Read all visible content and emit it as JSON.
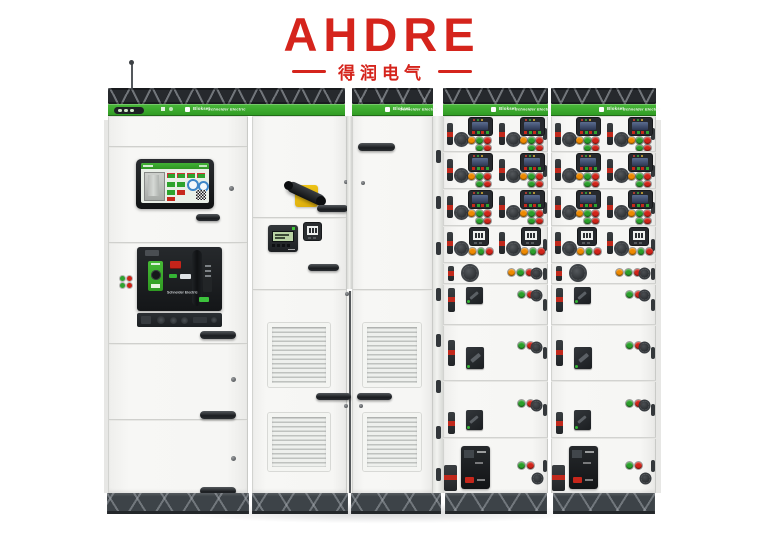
{
  "brand": {
    "name": "AHDRE",
    "tagline": "得润电气",
    "color": "#d5241c"
  },
  "band": {
    "product": "Blokset",
    "maker": "Schneider Electric",
    "green": "#36a527"
  },
  "acb": {
    "maker_label": "Schneider Electric"
  },
  "colors": {
    "button_green": "#2aa02a",
    "button_red": "#d2251a",
    "button_orange": "#ef8a00",
    "pilot_green": "#35b435",
    "truss": "#26292d",
    "plinth": "#3d4348",
    "cabinet_face": "#f5f5f3"
  },
  "mcc": {
    "row_heights": [
      36,
      37,
      37,
      37,
      21,
      41,
      56,
      57,
      55
    ],
    "rows": [
      {
        "type": "meter_pair",
        "top_buttons": [
          "orange",
          "green",
          "red"
        ],
        "bottom_buttons": [
          "green",
          "red"
        ]
      },
      {
        "type": "meter_pair",
        "top_buttons": [
          "orange",
          "green",
          "red"
        ],
        "bottom_buttons": [
          "green",
          "red"
        ]
      },
      {
        "type": "meter_pair",
        "top_buttons": [
          "orange",
          "green",
          "red"
        ],
        "bottom_buttons": [
          "green",
          "red"
        ]
      },
      {
        "type": "meter2_pair",
        "buttons": [
          "orange",
          "green",
          "red"
        ]
      },
      {
        "type": "knob_row",
        "buttons": [
          "orange",
          "green",
          "red"
        ]
      },
      {
        "type": "switch_row",
        "variant": "top",
        "buttons": [
          "green",
          "red"
        ]
      },
      {
        "type": "switch_row",
        "variant": "low",
        "buttons": [
          "green",
          "red"
        ]
      },
      {
        "type": "switch_row",
        "variant": "split",
        "buttons": [
          "green",
          "red"
        ]
      },
      {
        "type": "breaker_row",
        "buttons": [
          "green",
          "red"
        ]
      }
    ]
  }
}
